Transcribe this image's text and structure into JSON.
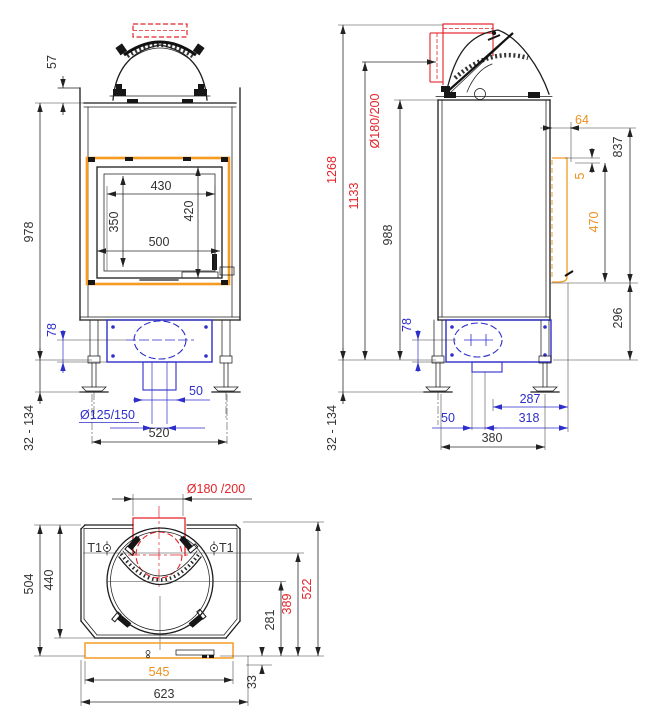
{
  "colors": {
    "line": "#1d1d1d",
    "dim_text": "#333333",
    "blue": "#2e2ecb",
    "red": "#e3242b",
    "orange": "#ef8f1f"
  },
  "front_view": {
    "d57": "57",
    "d978": "978",
    "d430": "430",
    "d350": "350",
    "d420": "420",
    "d500": "500",
    "d78": "78",
    "d50": "50",
    "d125": "Ø125/150",
    "d520": "520",
    "d32": "32 - 134"
  },
  "side_view": {
    "d1268": "1268",
    "d1133": "1133",
    "d988": "988",
    "d180": "Ø180/200",
    "d64": "64",
    "d837": "837",
    "d5": "5",
    "d470": "470",
    "d296": "296",
    "d78": "78",
    "d287": "287",
    "d50": "50",
    "d318": "318",
    "d380": "380",
    "d32": "32 - 134"
  },
  "top_view": {
    "d180": "Ø180 /200",
    "d504": "504",
    "d440": "440",
    "t1_left": "T1",
    "t1_right": "T1",
    "d522": "522",
    "d389": "389",
    "d281": "281",
    "d33": "33",
    "d545": "545",
    "d623": "623"
  }
}
